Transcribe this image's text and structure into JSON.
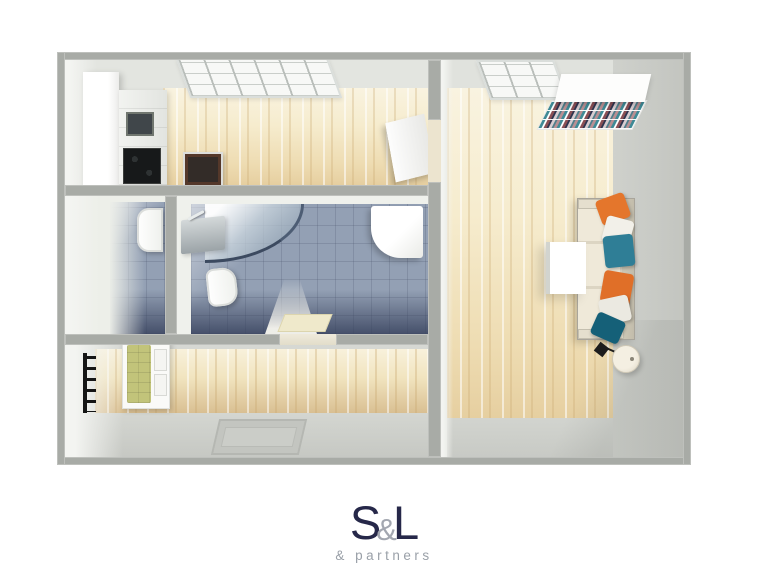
{
  "colors": {
    "wall": "#a8aba6",
    "room-bg": "#e3e5e0",
    "wood-light": "#f9f3e0",
    "wood-mid": "#eedcb2",
    "wood-dark": "#d9bf92",
    "tile": "#93a0b4",
    "tile-dark": "#4e5870",
    "floor-gray": "#c7c9c4",
    "sofa": "#e9e3d3",
    "pillow-orange": "#e4762c",
    "pillow-teal": "#2f7e96",
    "pillow-teal-dark": "#156078",
    "bench-olive": "#c2c47a",
    "logo-navy": "#262849",
    "logo-gray": "#9aa0a8"
  },
  "logo": {
    "letter_s": "S",
    "ampersand": "&",
    "letter_l": "L",
    "subtitle": "& partners"
  },
  "floorplan": {
    "description": "3D top-down render of a one-bedroom apartment floor plan",
    "rooms": [
      {
        "name": "kitchen",
        "floor": "light wood",
        "furniture": [
          "window",
          "tall-white-cabinet",
          "counter-with-sink",
          "black-cooktop",
          "oven"
        ]
      },
      {
        "name": "wc",
        "floor": "blue-gray tile",
        "furniture": [
          "toilet"
        ]
      },
      {
        "name": "bathroom",
        "floor": "blue-gray tile",
        "furniture": [
          "corner-shower",
          "wall-sink",
          "toilet",
          "washing-machine",
          "bath-mat"
        ]
      },
      {
        "name": "hallway",
        "floor": "light wood",
        "furniture": [
          "coat-rack",
          "shoe-bench-with-olive-cushion",
          "doormat"
        ]
      },
      {
        "name": "living-room",
        "floor": "light wood",
        "furniture": [
          "window",
          "bookshelf-with-books",
          "sofa-with-pillows",
          "coffee-table",
          "floor-lamp"
        ]
      }
    ]
  }
}
